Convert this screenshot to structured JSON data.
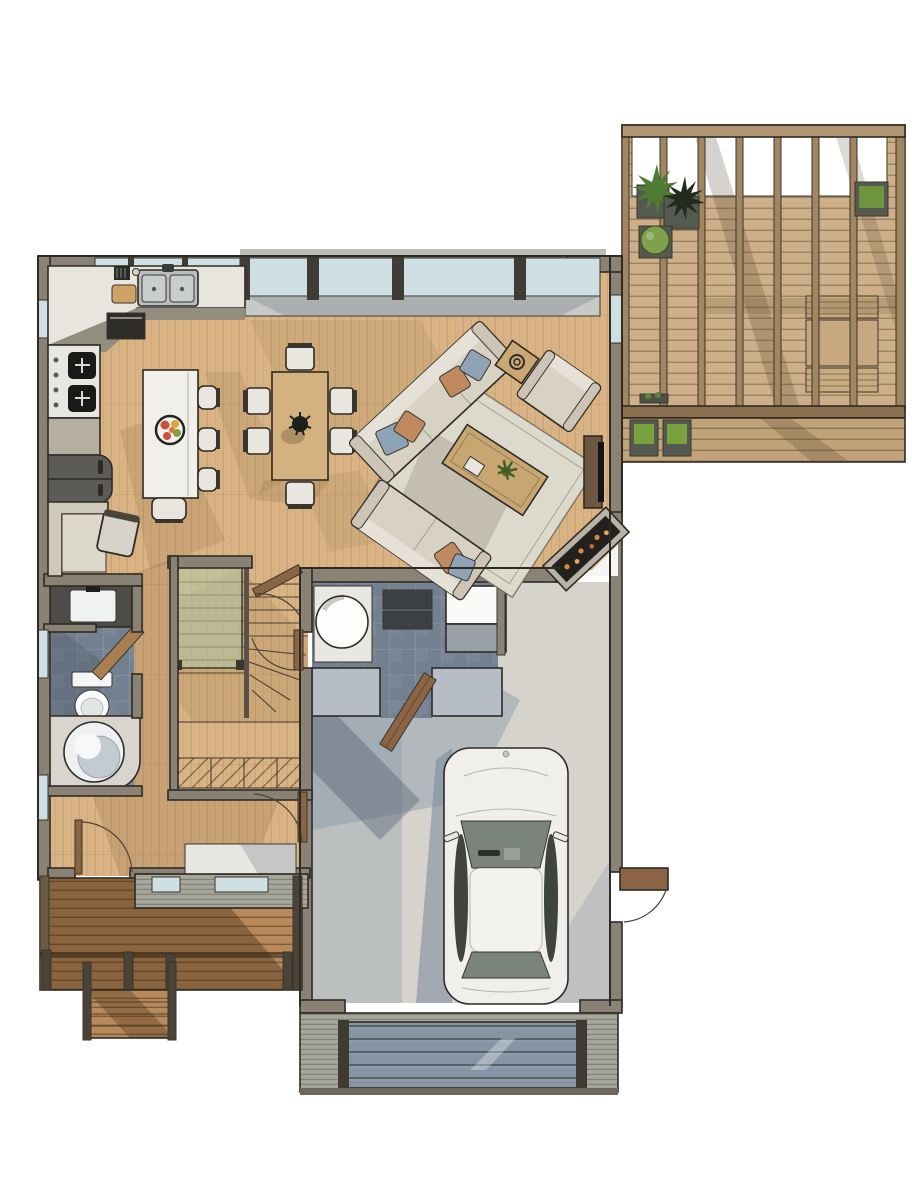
{
  "description": "Top-down 3D rendered residential first-floor plan",
  "palette": {
    "wall": "#8a8375",
    "wall_dark": "#4a443a",
    "wood_floor": "#d9b383",
    "deck_board": "#cdb08a",
    "deck_lower": "#c0a379",
    "deck_beam": "#a28662",
    "deck_header": "#b29573",
    "porch_board": "#b8895b",
    "tile": "#73808f",
    "garage_floor": "#d6d3cc",
    "cool_shadow": "#8796a9",
    "warm_shadow": "#6b4a22",
    "glass": "#cfe0e4",
    "stair_glass": "#b7c6a6",
    "counter": "#e7e5de",
    "cabinet": "#948e81",
    "island": "#f0efe9",
    "sink_steel": "#b9bdbf",
    "dining_table": "#d3b27f",
    "chair_seat": "#e9e7df",
    "sofa": "#d8d2c5",
    "sofa_cushion": "#e6e1d6",
    "pillow_blue": "#8ea3b6",
    "pillow_orange": "#c08a61",
    "rug": "#dcd9cd",
    "coffee_table": "#c8a671",
    "fireplace": "#23211e",
    "ember": "#d98a3f",
    "console_wood": "#6b5640",
    "tv": "#14151a",
    "car_body": "#f0efec",
    "car_glass_front": "#7b847a",
    "car_glass_side": "#3f443e",
    "door_wood": "#8a6444",
    "garage_door": "#8695a4",
    "siding": "#a6a79a",
    "planter": "#555a50",
    "plant_green": "#5d8436",
    "plant_bright": "#79a23e",
    "plant_dark": "#222b1c",
    "appliance_dark": "#3c3f43",
    "fridge": "#5c5b58",
    "water_heater": "#fdfdfc",
    "entry_mat": "#e9e7e2"
  },
  "scene": {
    "view": "top-down",
    "rooms": [
      {
        "name": "kitchen",
        "items": [
          {
            "name": "l-shaped-counter",
            "count": 1
          },
          {
            "name": "double-basin-sink",
            "count": 1
          },
          {
            "name": "faucet",
            "count": 1
          },
          {
            "name": "knife-block",
            "count": 1
          },
          {
            "name": "cutting-board",
            "count": 1
          },
          {
            "name": "gas-cooktop",
            "count": 1
          },
          {
            "name": "wall-oven",
            "count": 1
          },
          {
            "name": "refrigerator",
            "count": 1
          },
          {
            "name": "kitchen-island",
            "count": 1
          },
          {
            "name": "fruit-platter",
            "count": 1
          },
          {
            "name": "bar-stool",
            "count": 4
          },
          {
            "name": "breakfast-nook-bench",
            "count": 1
          },
          {
            "name": "nook-chair",
            "count": 1
          }
        ]
      },
      {
        "name": "dining-area",
        "items": [
          {
            "name": "dining-table",
            "count": 1
          },
          {
            "name": "dining-chair",
            "count": 6
          },
          {
            "name": "dark-centerpiece",
            "count": 1
          }
        ]
      },
      {
        "name": "living-room",
        "items": [
          {
            "name": "sofa",
            "count": 1
          },
          {
            "name": "loveseat",
            "count": 1
          },
          {
            "name": "armchair",
            "count": 1
          },
          {
            "name": "coffee-table",
            "count": 1
          },
          {
            "name": "potted-plant",
            "count": 1
          },
          {
            "name": "side-table",
            "count": 1
          },
          {
            "name": "area-rug",
            "count": 1
          },
          {
            "name": "media-console",
            "count": 1
          },
          {
            "name": "tv",
            "count": 1
          },
          {
            "name": "corner-fireplace",
            "count": 1
          },
          {
            "name": "deck-slider-opening",
            "count": 1
          }
        ]
      },
      {
        "name": "stair-hall",
        "items": [
          {
            "name": "u-shaped-staircase",
            "count": 1
          },
          {
            "name": "winder-treads",
            "count": 1
          },
          {
            "name": "glass-guardrail",
            "count": 1
          },
          {
            "name": "under-stair-closet",
            "count": 1
          },
          {
            "name": "door",
            "count": 2
          }
        ]
      },
      {
        "name": "powder-room",
        "items": [
          {
            "name": "vanity-sink",
            "count": 1
          },
          {
            "name": "toilet",
            "count": 1
          },
          {
            "name": "round-soaking-tub",
            "count": 1
          },
          {
            "name": "pony-wall",
            "count": 1
          },
          {
            "name": "window",
            "count": 3
          }
        ]
      },
      {
        "name": "entry-foyer",
        "items": [
          {
            "name": "front-door",
            "count": 1
          },
          {
            "name": "closet-door",
            "count": 1
          },
          {
            "name": "entry-mat",
            "count": 1
          }
        ]
      },
      {
        "name": "mudroom-laundry",
        "items": [
          {
            "name": "water-heater",
            "count": 1
          },
          {
            "name": "stacked-laundry-unit",
            "count": 1
          },
          {
            "name": "freezer",
            "count": 1
          },
          {
            "name": "half-wall",
            "count": 2
          },
          {
            "name": "open-wood-door",
            "count": 1
          }
        ]
      },
      {
        "name": "garage",
        "items": [
          {
            "name": "car",
            "count": 1
          },
          {
            "name": "garage-door",
            "count": 1
          },
          {
            "name": "side-entry-door",
            "count": 1
          }
        ]
      },
      {
        "name": "deck-pergola",
        "items": [
          {
            "name": "pergola-beam",
            "count": 8
          },
          {
            "name": "planter-box",
            "count": 6
          },
          {
            "name": "potted-plant",
            "count": 4
          },
          {
            "name": "outdoor-table",
            "count": 1
          },
          {
            "name": "outdoor-bench",
            "count": 2
          }
        ]
      },
      {
        "name": "front-porch",
        "items": [
          {
            "name": "porch-deck",
            "count": 1
          },
          {
            "name": "railing-post",
            "count": 5
          },
          {
            "name": "entry-steps",
            "count": 1
          }
        ]
      }
    ]
  }
}
